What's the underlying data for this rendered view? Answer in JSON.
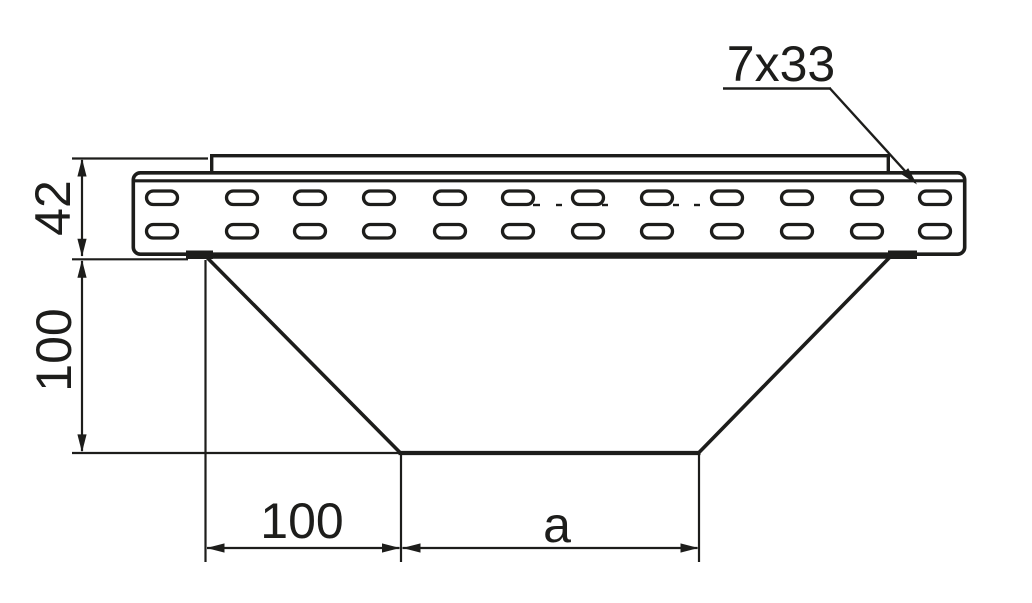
{
  "drawing": {
    "background_color": "#ffffff",
    "line_color": "#1d1d1b",
    "labels": {
      "slot_size": "7x33",
      "rail_height": "42",
      "drop_height": "100",
      "offset_width": "100",
      "width_a": "a"
    }
  }
}
